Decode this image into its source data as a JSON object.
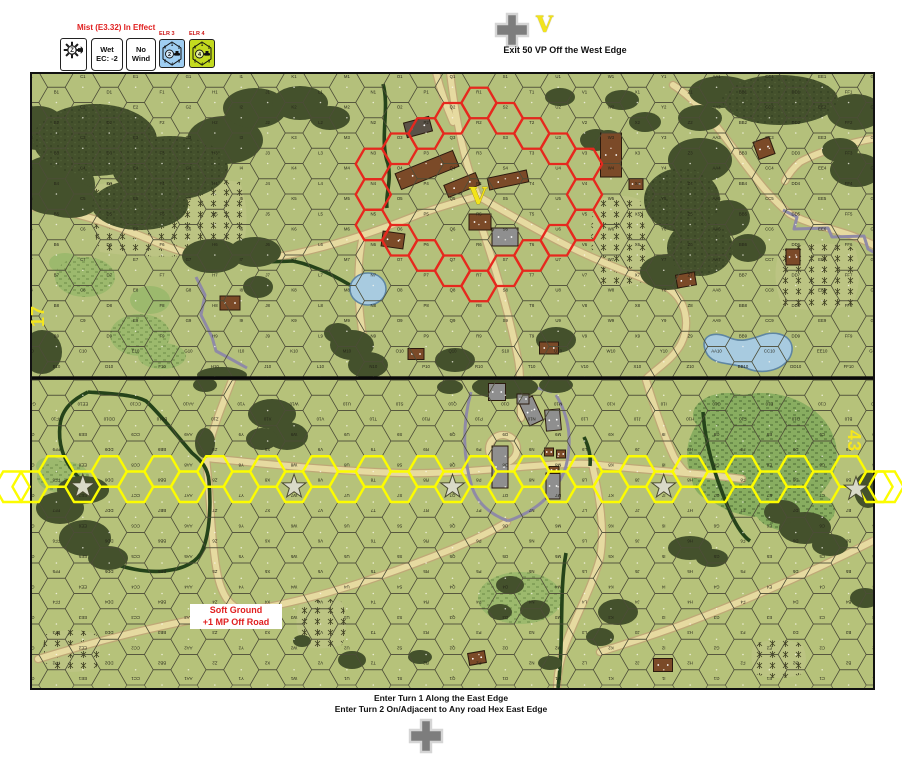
{
  "scenario": {
    "mist_note": "Mist (E3.32) In Effect",
    "exit_note": "Exit 50 VP Off the West Edge",
    "enter_note_line1": "Enter Turn 1 Along the East Edge",
    "enter_note_line2": "Enter Turn 2 On/Adjacent to Any road Hex East Edge",
    "objective_letter": "V"
  },
  "counters": {
    "wind_direction": {
      "letter": "Z"
    },
    "weather": {
      "line1": "Wet",
      "line2": "EC: -2"
    },
    "wind": {
      "line1": "No",
      "line2": "Wind"
    },
    "elr_left": {
      "label": "ELR 3",
      "value": "2",
      "color": "#9fcef2",
      "corner_numbers": [
        "6",
        "1",
        "2",
        "3",
        "4",
        "5"
      ]
    },
    "elr_right": {
      "label": "ELR 4",
      "value": "4",
      "color": "#c3da1f",
      "corner_numbers": [
        "6",
        "1",
        "2",
        "3",
        "4",
        "5"
      ]
    }
  },
  "map": {
    "board_top_number": "17",
    "board_bottom_number": "43",
    "village_objective_letter": "V",
    "soft_ground_note": {
      "line1": "Soft Ground",
      "line2": "+1 MP Off Road"
    },
    "rows_per_board": 10,
    "column_letters": [
      "A",
      "B",
      "C",
      "D",
      "E",
      "F",
      "G",
      "H",
      "I",
      "J",
      "K",
      "L",
      "M",
      "N",
      "O",
      "P",
      "Q",
      "R",
      "S",
      "T",
      "U",
      "V",
      "W",
      "X",
      "Y",
      "Z",
      "AA",
      "BB",
      "CC",
      "DD",
      "EE",
      "FF",
      "GG"
    ],
    "highlights": {
      "red_ring": {
        "color": "#e6281e",
        "center_col": 17,
        "center_y": 194.5,
        "offsets": [
          [
            -4,
            0
          ],
          [
            -4,
            -2
          ],
          [
            -4,
            2
          ],
          [
            -3,
            -3
          ],
          [
            -3,
            3
          ],
          [
            -2,
            -4
          ],
          [
            -2,
            4
          ],
          [
            -1,
            -5
          ],
          [
            -1,
            5
          ],
          [
            0,
            -6
          ],
          [
            0,
            6
          ],
          [
            1,
            -5
          ],
          [
            1,
            5
          ],
          [
            2,
            -4
          ],
          [
            2,
            4
          ],
          [
            3,
            -3
          ],
          [
            3,
            3
          ],
          [
            4,
            -2
          ],
          [
            4,
            0
          ],
          [
            4,
            2
          ]
        ]
      },
      "yellow_path": {
        "color": "#fcfc00",
        "even_col_y": 486.75,
        "odd_col_y": 471.5,
        "star_cols": [
          2,
          10,
          16,
          24
        ],
        "free_star": [
          856,
          489
        ],
        "offmap_hexes": [
          [
            12,
            486.75
          ],
          [
            886,
            486.75
          ]
        ]
      }
    }
  }
}
